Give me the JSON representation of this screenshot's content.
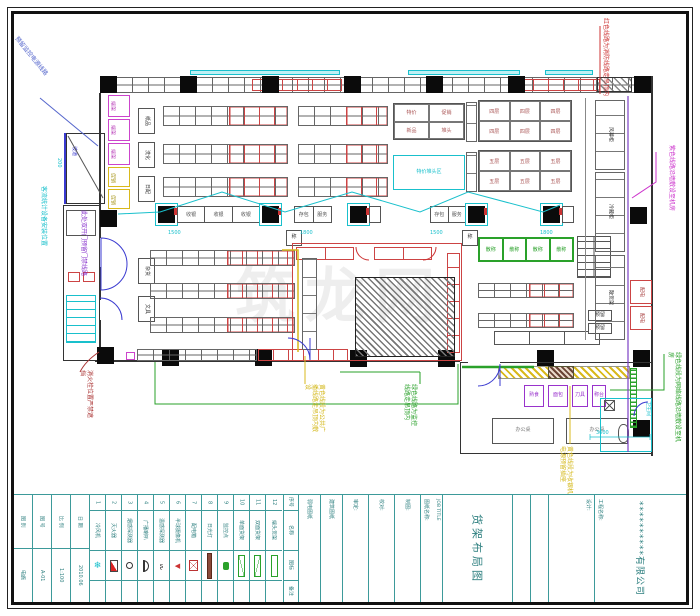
{
  "company": {
    "project_label": "工程名称:",
    "name": "**********有限公司",
    "design_label": "设计:"
  },
  "job": {
    "label": "图纸名称:",
    "en": "JOB TITLE",
    "title": "货架布局图"
  },
  "title_block": {
    "info_cols": [
      {
        "label": "图 别",
        "value": "电施"
      },
      {
        "label": "图 号",
        "value": "A-01"
      },
      {
        "label": "比 例",
        "value": "1:100"
      },
      {
        "label": "日 期",
        "value": "2010.06"
      }
    ],
    "doc_cols": [
      "弱电图纸",
      "建筑图纸"
    ],
    "sign_cols": [
      "审定:",
      "校对:",
      "制图:"
    ]
  },
  "legend": {
    "headers": [
      "序号",
      "名称",
      "图标",
      "备注"
    ],
    "items": [
      {
        "num": "1",
        "name": "冷风机",
        "icon": "snowflake"
      },
      {
        "num": "2",
        "name": "灭火器",
        "icon": "fire-extinguisher"
      },
      {
        "num": "3",
        "name": "烟感探测器",
        "icon": "smoke-detector"
      },
      {
        "num": "4",
        "name": "广播喇叭",
        "icon": "speaker-horn"
      },
      {
        "num": "5",
        "name": "温感探测器",
        "icon": "heat-sensor"
      },
      {
        "num": "6",
        "name": "半球摄像机",
        "icon": "dome-camera"
      },
      {
        "num": "7",
        "name": "配电箱",
        "icon": "power-box"
      },
      {
        "num": "8",
        "name": "日光灯",
        "icon": "light-bar"
      },
      {
        "num": "9",
        "name": "监控点",
        "icon": "monitor-point"
      },
      {
        "num": "10",
        "name": "单面货架",
        "icon": "rack-single"
      },
      {
        "num": "11",
        "name": "双面货架",
        "icon": "rack-double"
      },
      {
        "num": "12",
        "name": "端头货架",
        "icon": "rack-end"
      }
    ]
  },
  "annotations": {
    "red_top": "红色线路为消防线路走吊顶内",
    "magenta_right": "紫色线路沿墙敷设至机房",
    "blue_left": "预留监控电源线路",
    "cyan_left": "客流统计设备安装位置",
    "purple_door": "此处双开门预留门禁线路",
    "darkred_bl": "消火栓位置严禁遮挡",
    "yellow_left": "黄色线段为公共广播线路走吊顶内敷设",
    "green_center": "绿色线路为监控线路走吊顶内",
    "yellow_right": "黄色线段为收银机电源预留插座",
    "green_right": "绿色线段为网络线路沿墙敷设至机房",
    "watermark": "筑龙网"
  },
  "plan": {
    "ramp_label": "坡道",
    "aisle_labels": [
      "纸品",
      "洗化",
      "日配",
      "杂货",
      "文具"
    ],
    "mag_stack": [
      "端架",
      "端架",
      "端架"
    ],
    "yellow_stack": [
      "促销",
      "促销"
    ],
    "checkout": {
      "cells": [
        "收银",
        "收银",
        "收银"
      ],
      "pair": [
        "存包",
        "服务"
      ],
      "small1": "称",
      "small2": "称",
      "dims": [
        "1500",
        "1800",
        "1500",
        "1800"
      ]
    },
    "tables": {
      "t1": [
        "特价",
        "促销",
        "新品",
        "堆头"
      ],
      "t2": [
        "四层",
        "四层",
        "四层",
        "四层",
        "四层",
        "四层"
      ],
      "t3": [
        "五层",
        "五层",
        "五层",
        "五层",
        "五层",
        "五层"
      ],
      "promo_label": "特价堆头区",
      "green_cells": [
        "散称",
        "散称",
        "散称",
        "散称"
      ]
    },
    "right_counters": [
      "风幕柜",
      "冷藏柜",
      "散货架"
    ],
    "red_boxes": [
      "配电",
      "配电"
    ],
    "reserve_boxes": [
      "预留",
      "预留"
    ],
    "room": {
      "purple_boxes": [
        "熟食",
        "面包",
        "刀具",
        "称台"
      ],
      "desks": [
        "办公桌",
        "办公桌"
      ],
      "toilet": "卫生间",
      "dim": "3600"
    },
    "dims": {
      "d200": "200"
    }
  }
}
